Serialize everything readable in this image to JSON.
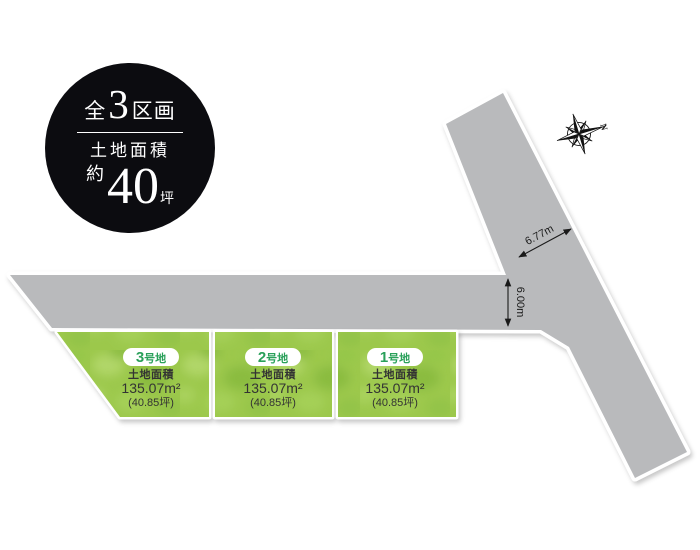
{
  "header_badge": {
    "total_prefix": "全",
    "total_number": "3",
    "total_suffix": "区画",
    "area_title": "土地面積",
    "area_approx": "約",
    "area_number": "40",
    "area_unit": "坪"
  },
  "compass": {
    "north": "N"
  },
  "roads": {
    "diagonal_width_label": "6.77m",
    "horizontal_width_label": "6.00m"
  },
  "plots": [
    {
      "number": "3",
      "suffix": "号地",
      "area_title": "土地面積",
      "area_m2": "135.07m²",
      "area_tsubo": "(40.85坪)"
    },
    {
      "number": "2",
      "suffix": "号地",
      "area_title": "土地面積",
      "area_m2": "135.07m²",
      "area_tsubo": "(40.85坪)"
    },
    {
      "number": "1",
      "suffix": "号地",
      "area_title": "土地面積",
      "area_m2": "135.07m²",
      "area_tsubo": "(40.85坪)"
    }
  ],
  "colors": {
    "road_gray": "#b9babc",
    "plot_green_base": "#9cc84c",
    "plot_green_light": "#bfe07c",
    "plot_green_dark": "#7fb438",
    "plot_label_green": "#2aa05a",
    "badge_black": "#0c0c10",
    "text_dark": "#333333",
    "outline_white": "#ffffff"
  }
}
